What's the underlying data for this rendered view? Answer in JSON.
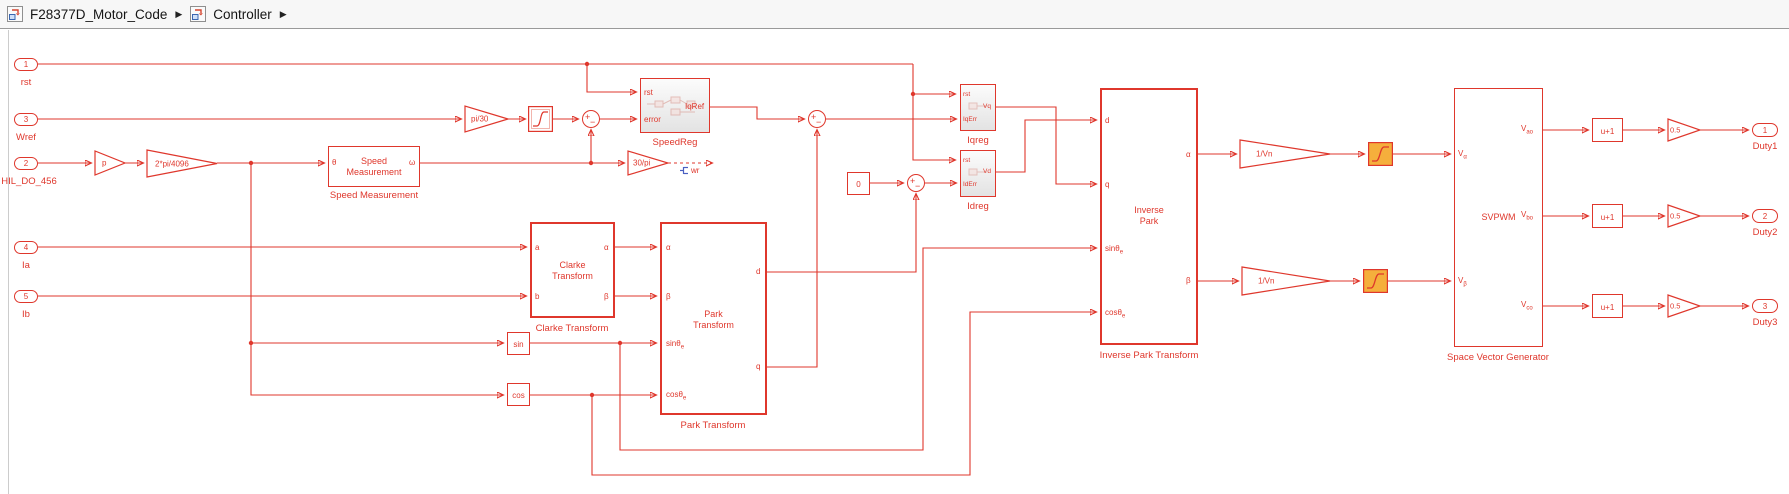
{
  "breadcrumb": {
    "item1": "F28377D_Motor_Code",
    "item2": "Controller",
    "sep": "▶"
  },
  "inports": {
    "rst": {
      "num": "1",
      "label": "rst"
    },
    "wref": {
      "num": "3",
      "label": "Wref"
    },
    "hil": {
      "num": "2",
      "label": "HIL_DO_456"
    },
    "ia": {
      "num": "4",
      "label": "Ia"
    },
    "ib": {
      "num": "5",
      "label": "Ib"
    }
  },
  "outports": {
    "duty1": {
      "num": "1",
      "label": "Duty1"
    },
    "duty2": {
      "num": "2",
      "label": "Duty2"
    },
    "duty3": {
      "num": "3",
      "label": "Duty3"
    }
  },
  "gains": {
    "p": "p",
    "rad_per_count": "2*pi/4096",
    "pi_over_30": "pi/30",
    "thirty_over_pi": "30/pi",
    "inv_vn_alpha": "1/Vn",
    "inv_vn_beta": "1/Vn",
    "half_1": "0.5",
    "half_2": "0.5",
    "half_3": "0.5"
  },
  "blocks": {
    "speed_measurement": {
      "line1": "Speed",
      "line2": "Measurement",
      "label": "Speed Measurement",
      "in_theta": "θ",
      "out_omega": "ω"
    },
    "speedreg": {
      "label": "SpeedReg",
      "in_rst": "rst",
      "in_error": "error",
      "out": "IqRef"
    },
    "clarke": {
      "line1": "Clarke",
      "line2": "Transform",
      "label": "Clarke Transform",
      "in_a": "a",
      "in_b": "b",
      "out_alpha": "α",
      "out_beta": "β"
    },
    "park": {
      "line1": "Park",
      "line2": "Transform",
      "label": "Park Transform",
      "in_alpha": "α",
      "in_beta": "β",
      "in_sin": "sinθ",
      "in_sin_sub": "e",
      "in_cos": "cosθ",
      "in_cos_sub": "e",
      "out_d": "d",
      "out_q": "q"
    },
    "sin": {
      "label": "sin"
    },
    "cos": {
      "label": "cos"
    },
    "zero": {
      "label": "0"
    },
    "iqreg": {
      "label": "Iqreg",
      "in_rst": "rst",
      "in_err": "IqErr",
      "out": "Vq"
    },
    "idreg": {
      "label": "Idreg",
      "in_rst": "rst",
      "in_err": "IdErr",
      "out": "Vd"
    },
    "inverse_park": {
      "line1": "Inverse",
      "line2": "Park",
      "label": "Inverse Park Transform",
      "in_d": "d",
      "in_q": "q",
      "in_sin": "sinθ",
      "in_sin_sub": "e",
      "in_cos": "cosθ",
      "in_cos_sub": "e",
      "out_alpha": "α",
      "out_beta": "β"
    },
    "svpwm": {
      "title": "SVPWM",
      "label": "Space Vector Generator",
      "in_va": "V",
      "in_va_sub": "α",
      "in_vb": "V",
      "in_vb_sub": "β",
      "out_ao": "V",
      "out_ao_sub": "ao",
      "out_bo": "V",
      "out_bo_sub": "bo",
      "out_co": "V",
      "out_co_sub": "co"
    },
    "u_plus_one_1": "u+1",
    "u_plus_one_2": "u+1",
    "u_plus_one_3": "u+1"
  },
  "annotations": {
    "wr": "wr"
  },
  "colors": {
    "wire": "#DF372C",
    "saturation_fill": "#F5AF3C",
    "badge_blue": "#4A5FC1"
  }
}
